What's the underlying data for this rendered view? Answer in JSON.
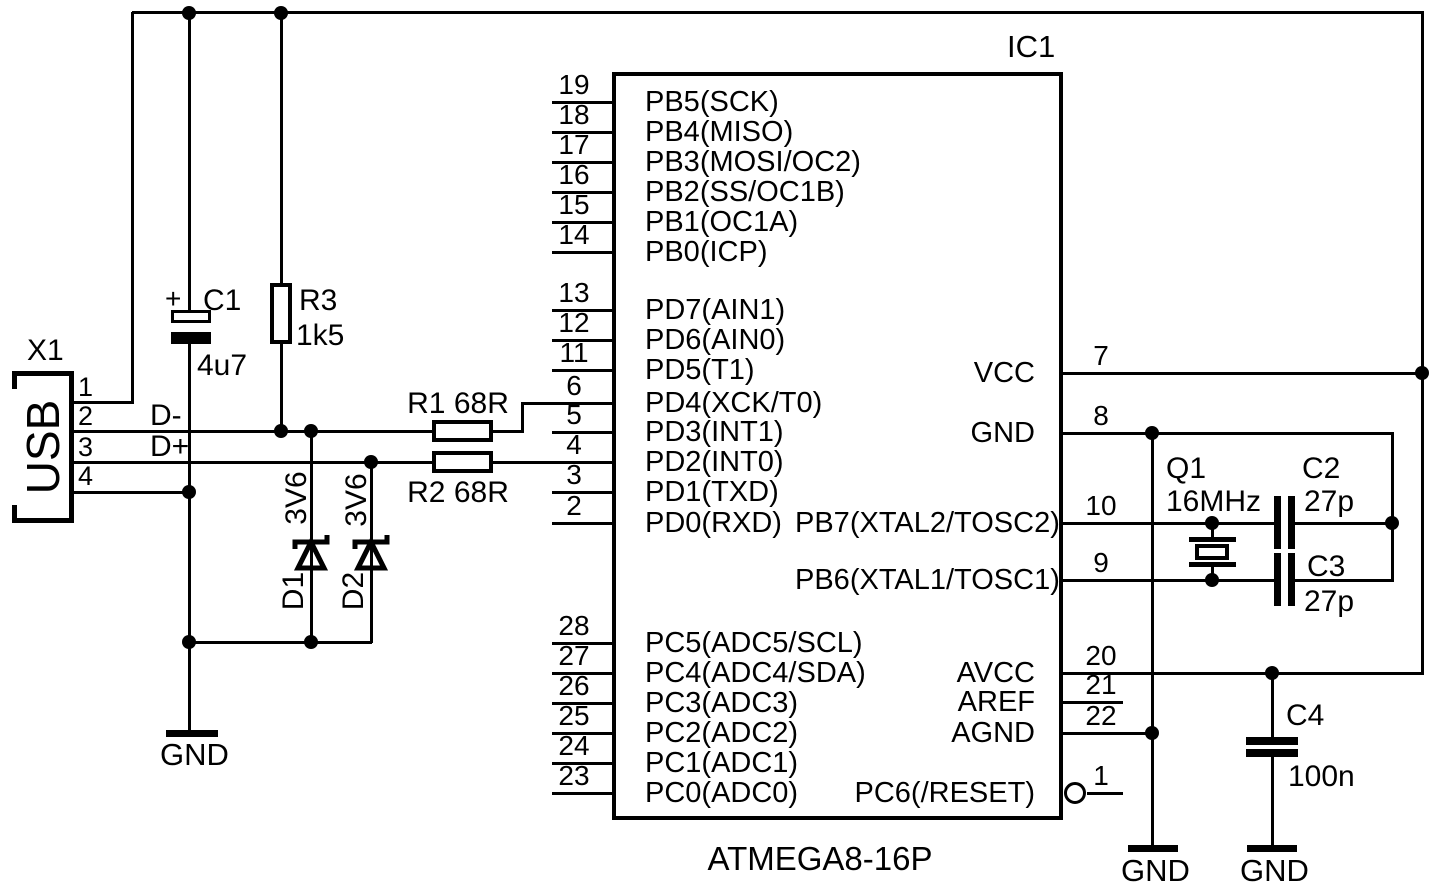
{
  "colors": {
    "ink": "#000000",
    "background": "#ffffff"
  },
  "usb": {
    "ref": "X1",
    "label": "USB",
    "pin_numbers": [
      "1",
      "2",
      "3",
      "4"
    ]
  },
  "signals": {
    "d_minus": "D-",
    "d_plus": "D+"
  },
  "components": {
    "c1": {
      "ref": "C1",
      "value": "4u7",
      "polarity": "+"
    },
    "r3": {
      "ref": "R3",
      "value": "1k5"
    },
    "r1": {
      "label": "R1 68R"
    },
    "r2": {
      "label": "R2 68R"
    },
    "d1": {
      "ref": "D1",
      "value": "3V6"
    },
    "d2": {
      "ref": "D2",
      "value": "3V6"
    },
    "q1": {
      "ref": "Q1",
      "value": "16MHz"
    },
    "c2": {
      "ref": "C2",
      "value": "27p"
    },
    "c3": {
      "ref": "C3",
      "value": "27p"
    },
    "c4": {
      "ref": "C4",
      "value": "100n"
    }
  },
  "ic": {
    "ref": "IC1",
    "part": "ATMEGA8-16P",
    "left_pins": [
      {
        "num": "19",
        "label": "PB5(SCK)"
      },
      {
        "num": "18",
        "label": "PB4(MISO)"
      },
      {
        "num": "17",
        "label": "PB3(MOSI/OC2)"
      },
      {
        "num": "16",
        "label": "PB2(SS/OC1B)"
      },
      {
        "num": "15",
        "label": "PB1(OC1A)"
      },
      {
        "num": "14",
        "label": "PB0(ICP)"
      },
      {
        "num": "13",
        "label": "PD7(AIN1)"
      },
      {
        "num": "12",
        "label": "PD6(AIN0)"
      },
      {
        "num": "11",
        "label": "PD5(T1)"
      },
      {
        "num": "6",
        "label": "PD4(XCK/T0)"
      },
      {
        "num": "5",
        "label": "PD3(INT1)"
      },
      {
        "num": "4",
        "label": "PD2(INT0)"
      },
      {
        "num": "3",
        "label": "PD1(TXD)"
      },
      {
        "num": "2",
        "label": "PD0(RXD)"
      },
      {
        "num": "28",
        "label": "PC5(ADC5/SCL)"
      },
      {
        "num": "27",
        "label": "PC4(ADC4/SDA)"
      },
      {
        "num": "26",
        "label": "PC3(ADC3)"
      },
      {
        "num": "25",
        "label": "PC2(ADC2)"
      },
      {
        "num": "24",
        "label": "PC1(ADC1)"
      },
      {
        "num": "23",
        "label": "PC0(ADC0)"
      }
    ],
    "right_pins": [
      {
        "num": "7",
        "label": "VCC"
      },
      {
        "num": "8",
        "label": "GND"
      },
      {
        "num": "10",
        "label": "PB7(XTAL2/TOSC2)"
      },
      {
        "num": "9",
        "label": "PB6(XTAL1/TOSC1)"
      },
      {
        "num": "20",
        "label": "AVCC"
      },
      {
        "num": "21",
        "label": "AREF"
      },
      {
        "num": "22",
        "label": "AGND"
      },
      {
        "num": "1",
        "label": "PC6(/RESET)"
      }
    ]
  },
  "ground_labels": [
    "GND",
    "GND",
    "GND"
  ]
}
